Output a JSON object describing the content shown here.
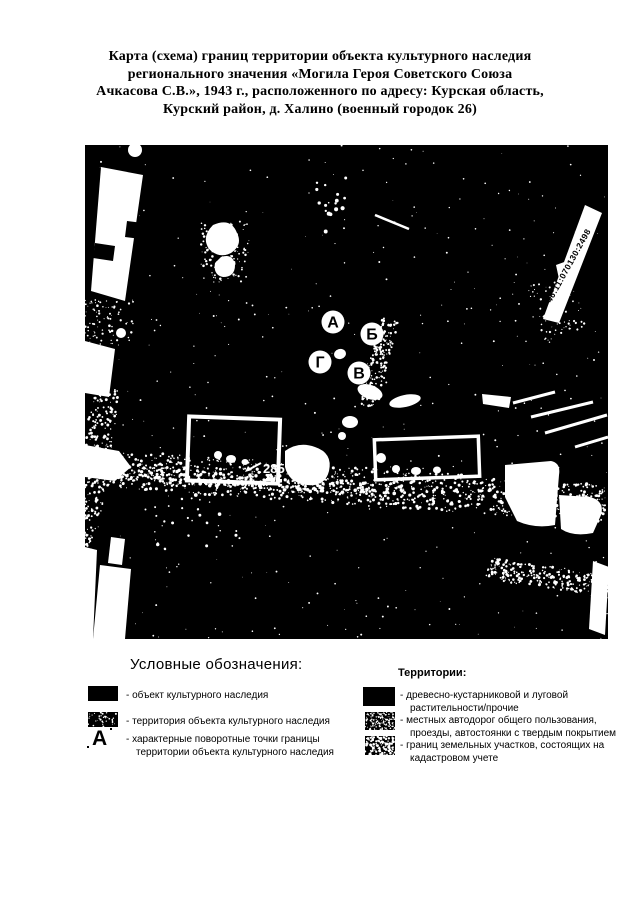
{
  "page": {
    "title": "Карта (схема) границ территории объекта культурного наследия\nрегионального значения «Могила Героя Советского Союза\nАчкасова С.В.», 1943 г., расположенного по адресу: Курская область,\nКурский район, д. Халино (военный городок 26)"
  },
  "map": {
    "cadastral_number": "46:11:070130:2498",
    "house_number": "285",
    "points": [
      {
        "label": "А",
        "x": 248,
        "y": 177
      },
      {
        "label": "Б",
        "x": 287,
        "y": 189
      },
      {
        "label": "Г",
        "x": 235,
        "y": 217
      },
      {
        "label": "В",
        "x": 274,
        "y": 228
      }
    ]
  },
  "legend": {
    "left": {
      "heading": "Условные обозначения:",
      "items": [
        {
          "symbol": "solid-black-swatch",
          "label": "- объект культурного наследия"
        },
        {
          "symbol": "speckled-swatch",
          "label": "- территория объекта культурного наследия"
        },
        {
          "symbol": "letter-a-marker",
          "symbol_label": "А",
          "label": "- характерные поворотные точки границы\nтерритории объекта культурного наследия"
        }
      ]
    },
    "right": {
      "heading": "Территории:",
      "items": [
        {
          "symbol": "solid-black-swatch",
          "label": "- древесно-кустарниковой и луговой\nрастительности/прочие"
        },
        {
          "symbol": "fine-speckled-swatch",
          "label": "- местных автодорог общего пользования,\nпроезды, автостоянки с твердым покрытием"
        },
        {
          "symbol": "coarse-speckled-swatch",
          "label": "- границ земельных участков, состоящих на\nкадастровом учете"
        }
      ]
    }
  },
  "colors": {
    "map_background": "#000000",
    "map_foreground": "#ffffff",
    "text": "#000000"
  }
}
